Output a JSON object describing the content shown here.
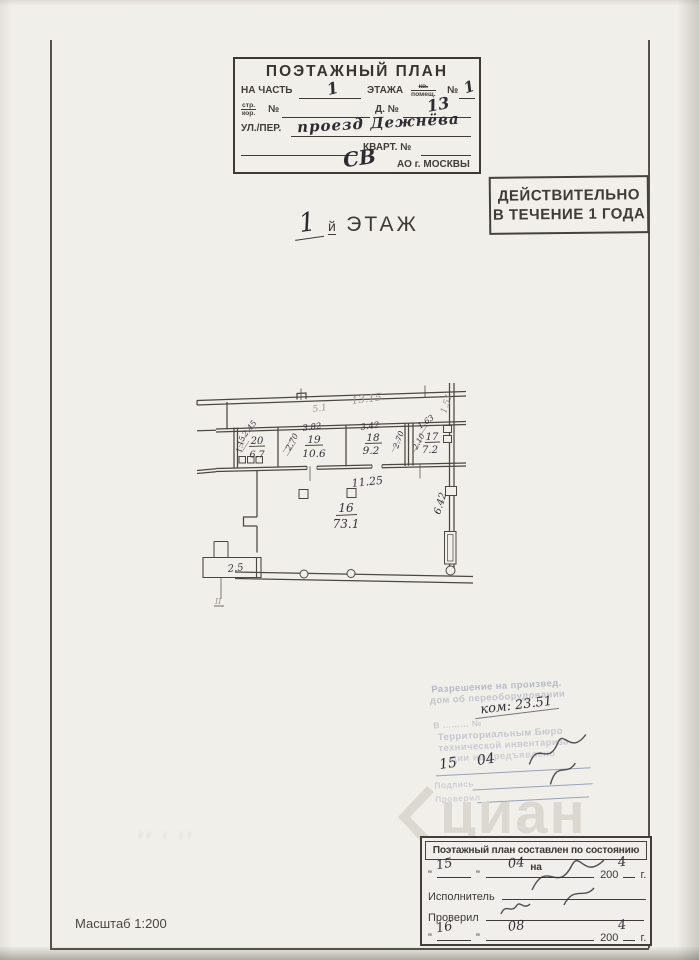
{
  "header_stamp": {
    "title": "ПОЭТАЖНЫЙ ПЛАН",
    "row1": {
      "label_a": "НА ЧАСТЬ",
      "hw_a": "1",
      "label_b": "ЭТАЖА",
      "stack_top": "кв.",
      "stack_bottom": "помещ.",
      "no": "№",
      "hw_b": "1"
    },
    "row2": {
      "stack_top": "стр.",
      "stack_bottom": "кор.",
      "no": "№",
      "label_b": "Д. №",
      "hw": "13"
    },
    "row3": {
      "label": "УЛ./ПЕР.",
      "hw": "проезд Дежнёва"
    },
    "row4": {
      "label": "КВАРТ. №"
    },
    "row5": {
      "hw": "СВ",
      "label": "АО г. МОСКВЫ"
    }
  },
  "validity_stamp": {
    "line1": "ДЕЙСТВИТЕЛЬНО",
    "line2": "В ТЕЧЕНИЕ 1 ГОДА"
  },
  "floor_title": {
    "hw_number": "1",
    "suffix": "й",
    "word": "ЭТАЖ"
  },
  "plan": {
    "rooms": [
      {
        "number": "20",
        "area": "6.7"
      },
      {
        "number": "19",
        "area": "10.6"
      },
      {
        "number": "18",
        "area": "9.2"
      },
      {
        "number": "17",
        "area": "7.2"
      },
      {
        "number": "16",
        "area": "73.1"
      }
    ],
    "dims": {
      "corridor": "5.1",
      "top": "13.15",
      "right_top": "1.51",
      "r20_w": "2.45",
      "r20_h": "1.15",
      "r19_w": "3.82",
      "r19_h": "2.70",
      "r18_w": "3.42",
      "r18_h": "2.70",
      "r17_w": "1.63",
      "r17_h": "2.10",
      "r16_w": "11.25",
      "r16_h": "6.42",
      "annex": "2.5",
      "mark": "II"
    }
  },
  "blue_stamp": {
    "line1": "Разрешение на произвед.",
    "line2": "дом об переоборудовании",
    "hw_note": "ком: 23.51",
    "line3": "В ……… №",
    "line4": "Территориальным Бюро",
    "line5": "технической инвентариза-",
    "line6": "ции не предъявлено",
    "hw_day": "15",
    "hw_month": "04",
    "line7": "Подпись",
    "line8": "Проверил"
  },
  "bottom_box": {
    "title": "Поэтажный план составлен по состоянию на",
    "quote": "\"",
    "row1": {
      "hw_day": "15",
      "hw_month": "04",
      "year": "200",
      "hw_year": "4",
      "g": "г."
    },
    "executor_label": "Исполнитель",
    "checked_label": "Проверил",
    "row2": {
      "hw_day": "16",
      "hw_month": "08",
      "year": "200",
      "hw_year": "4",
      "g": "г."
    }
  },
  "scale_label": "Масштаб 1:200",
  "watermark": "циан",
  "faint_marks": "ıı ı ıı"
}
